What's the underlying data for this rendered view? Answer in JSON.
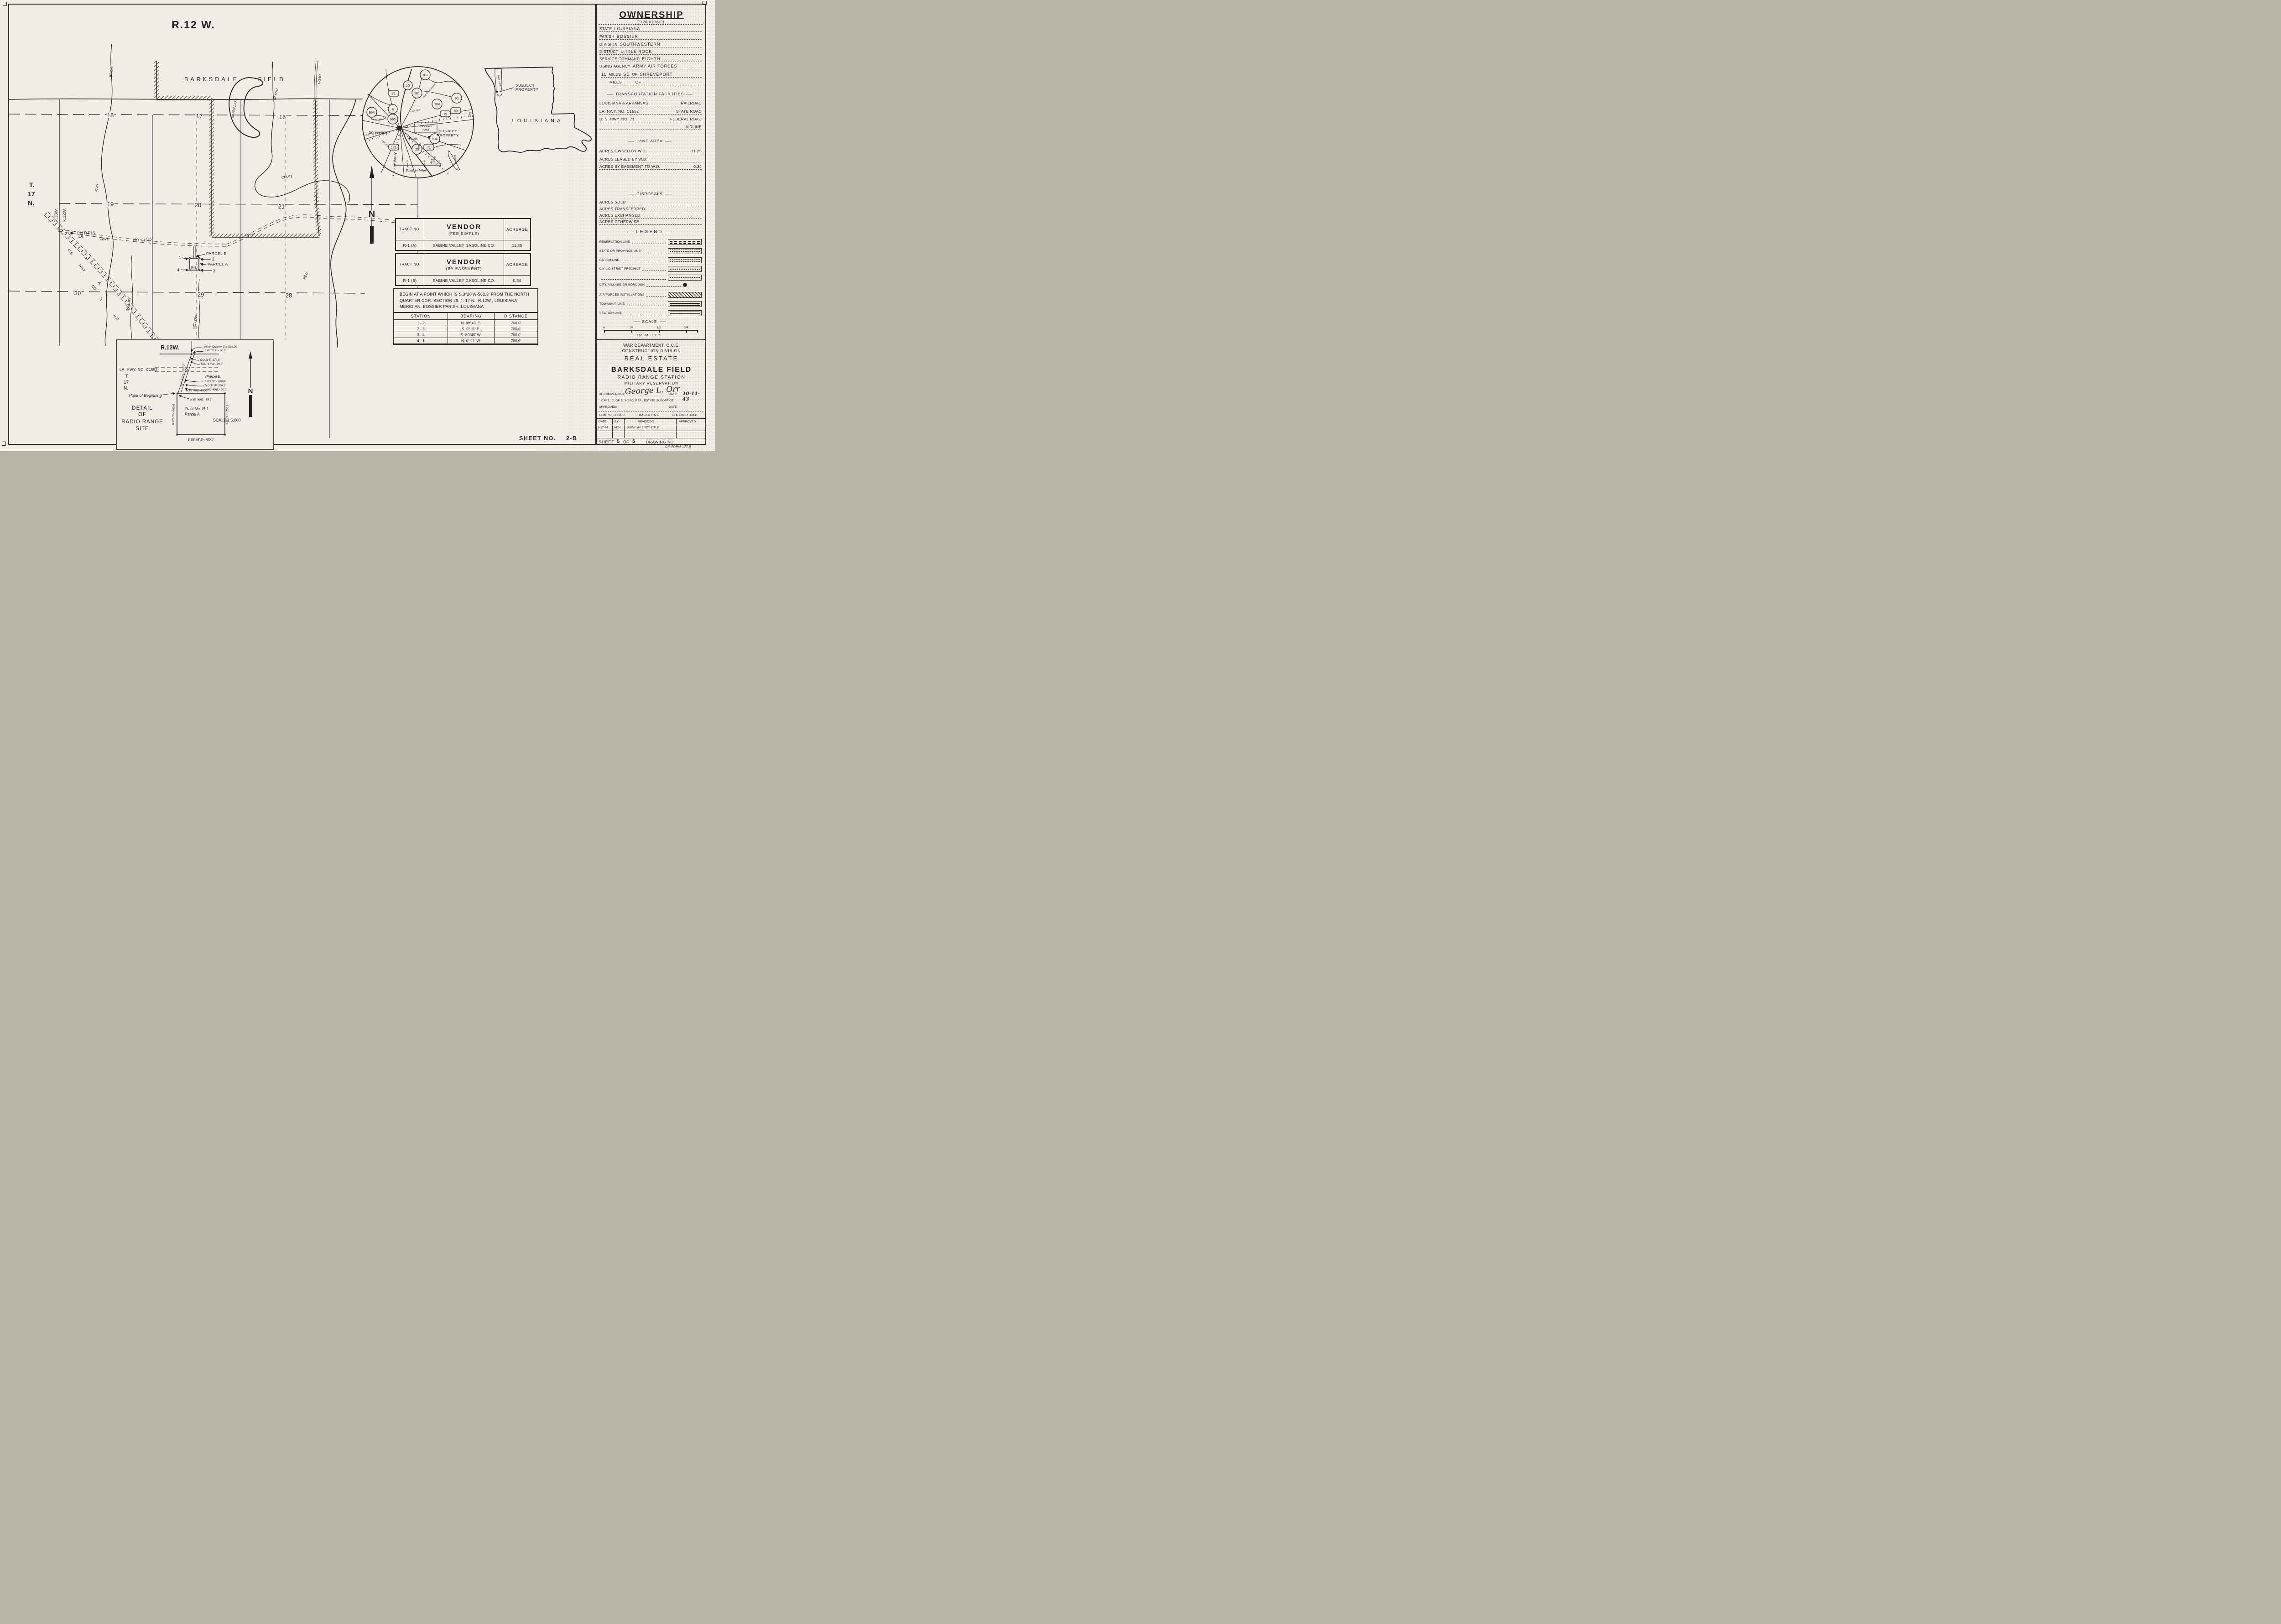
{
  "sheet": {
    "sheet_no_label": "SHEET NO.",
    "sheet_no_value": "2-B",
    "form_no": "CR-FORM-177.B"
  },
  "ownership": {
    "title": "OWNERSHIP",
    "subtitle": "(TYPE OF MAP)",
    "rows": [
      {
        "label": "STATE",
        "value": "LOUISIANA"
      },
      {
        "label": "PARISH",
        "value": "BOSSIER"
      },
      {
        "label": "DIVISION",
        "value": "SOUTHWESTERN"
      },
      {
        "label": "DISTRICT",
        "value": "LITTLE ROCK"
      },
      {
        "label": "SERVICE COMMAND",
        "value": "EIGHTH"
      },
      {
        "label": "USING AGENCY",
        "value": "ARMY AIR FORCES"
      }
    ],
    "distance1": {
      "n": "11",
      "miles": "MILES",
      "dir": "SE",
      "of": "OF",
      "place": "SHREVEPORT"
    },
    "distance2": {
      "miles": "MILES",
      "of": "OF"
    }
  },
  "transportation": {
    "header": "TRANSPORTATION FACILITIES",
    "r1": {
      "name": "LOUISIANA & ARKANSAS",
      "type": "RAILROAD"
    },
    "r2": {
      "name": "LA. HWY. NO. C1552",
      "type": "STATE ROAD"
    },
    "r3": {
      "name": "U. S. HWY. NO. 71",
      "type": "FEDERAL ROAD"
    },
    "r4": {
      "name": "",
      "type": "AIRLINE"
    }
  },
  "land_area": {
    "header": "LAND AREA",
    "rows": [
      {
        "label": "ACRES OWNED BY W.D.",
        "value": "11.25"
      },
      {
        "label": "ACRES LEASED BY W.D.",
        "value": ""
      },
      {
        "label": "ACRES BY EASEMENT TO W.D.",
        "value": "0.34"
      }
    ]
  },
  "disposals": {
    "header": "DISPOSALS",
    "rows": [
      {
        "label": "ACRES SOLD",
        "value": ""
      },
      {
        "label": "ACRES TRANSFERRED",
        "value": ""
      },
      {
        "label": "ACRES EXCHANGED",
        "value": ""
      },
      {
        "label": "ACRES OTHERWISE",
        "value": ""
      }
    ]
  },
  "legend": {
    "header": "LEGEND",
    "items": [
      {
        "label": "RESERVATION LINE"
      },
      {
        "label": "STATE OR PROVINCE LINE"
      },
      {
        "label": "PARISH LINE"
      },
      {
        "label": "CIVIL DISTRICT PRECINCT"
      },
      {
        "label": ""
      },
      {
        "label": "CITY, VILLAGE OR BOROUGH"
      },
      {
        "label": "AIR FORCES INSTALLATIONS"
      },
      {
        "label": "TOWNSHIP LINE"
      },
      {
        "label": "SECTION LINE"
      }
    ],
    "scale_header": "SCALE",
    "scale_ticks": [
      "0",
      "1/4",
      "1/2",
      "3/4"
    ],
    "scale_units": "IN MILES"
  },
  "title_block": {
    "dept": "WAR DEPARTMENT, O.C.E.",
    "division": "CONSTRUCTION DIVISION",
    "category": "REAL ESTATE",
    "installation": "BARKSDALE FIELD",
    "station": "RADIO RANGE STATION",
    "reservation": "MILITARY RESERVATION",
    "recommended_label": "RECOMMENDED:",
    "signature": "George L. Orr",
    "date_label": "DATE:",
    "date_value": "10-11-43",
    "signer_title": "CAPT., C. OF E., HEAD, REAL ESTATE SUBOFFICE",
    "approved_label": "APPROVED:",
    "approved_date_label": "DATE:",
    "compiled": "COMPILED F.A.C.",
    "traced": "TRACED F.A.C.",
    "checked": "CHECKED B.R.P."
  },
  "revisions": {
    "date_header": "DATE",
    "by_header": "BY",
    "revisions_header": "REVISIONS",
    "approved_header": "APPROVED",
    "row_date": "3-17-44",
    "row_by": "HEN",
    "row_text": "USING AGENCY TITLE",
    "row_approved": ""
  },
  "sheet_line": {
    "label": "SHEET",
    "number": "5",
    "of": "OF",
    "total": "5",
    "drawing_label": "DRAWING NO."
  },
  "vendor_fee": {
    "tract_header": "TRACT NO.",
    "vendor_header": "VENDOR",
    "vendor_sub": "(FEE SIMPLE)",
    "acreage_header": "ACREAGE",
    "tract": "R-1 (A)",
    "vendor": "SABINE VALLEY GASOLINE CO.",
    "acreage": "11.25"
  },
  "vendor_easement": {
    "tract_header": "TRACT NO.",
    "vendor_header": "VENDOR",
    "vendor_sub": "(BY EASEMENT)",
    "acreage_header": "ACREAGE",
    "tract": "R-1 (B)",
    "vendor": "SABINE VALLEY GASOLINE CO.",
    "acreage": "0.34"
  },
  "metes_bounds": {
    "description": "BEGIN AT A POINT WHICH IS S.3°20'W-563.3' FROM THE NORTH QUARTER COR. SECTION 29, T. 17 N., R.12W., LOUISIANA MERIDIAN, BOSSIER PARISH, LOUISIANA",
    "station_header": "STATION",
    "bearing_header": "BEARING",
    "distance_header": "DISTANCE",
    "rows": [
      {
        "station": "1 - 2",
        "bearing": "N. 89°49' E.",
        "distance": "700.0'"
      },
      {
        "station": "2 - 3",
        "bearing": "S. 0° 11' E.",
        "distance": "700.0'"
      },
      {
        "station": "3 - 4",
        "bearing": "S. 89°49' W.",
        "distance": "700.0'"
      },
      {
        "station": "4 - 1",
        "bearing": "N. 0° 11' W.",
        "distance": "700.0'"
      }
    ]
  },
  "main_map": {
    "range_label": "R.12 W.",
    "field_1": "BARKSDALE",
    "field_2": "FIELD",
    "t": "T.",
    "t17": "17",
    "tn": "N.",
    "range_left": "R.13W.",
    "range_right": "R.12W.",
    "s18": "18",
    "s17": "17",
    "s16": "16",
    "s19": "19",
    "s20": "20",
    "s21": "21",
    "s30": "30",
    "s29": "29",
    "s28": "28",
    "curtis": "CURTIS",
    "la": "LA.",
    "hwy": "HWY.",
    "no_c1552": "NO. C1552",
    "us": "U.S.",
    "us_hwy": "HWY.",
    "us_no": "NO.",
    "us_71": "71",
    "rr_l": "L.",
    "rr_a": "A.",
    "rr_rr": "R.R.",
    "river": "RIVER",
    "flat": "FLAT",
    "chute": "CHUTE",
    "bayou": "BAYOU",
    "red": "RED",
    "road": "ROAD",
    "moon_lake": "MOON LAKE",
    "willow": "WILLOW",
    "parcel_a": "PARCEL A",
    "parcel_b": "PARCEL B",
    "tract": "R-1",
    "c1": "1",
    "c2": "2",
    "c3": "3",
    "c4": "4",
    "north": "N"
  },
  "vicinity": {
    "shield_182": "182",
    "shield_10": "10",
    "shield_181": "181",
    "shield_71": "71",
    "shield_90": "90",
    "shield_184": "184",
    "shield_80": "80",
    "shield_79": "79",
    "shield_8": "8",
    "shield_994": "994",
    "shield_995": "995",
    "shield_934": "934",
    "shield_20": "20",
    "shield_171": "171",
    "shield_71b": "71",
    "shreveport": "Shreveport",
    "cross_lake": "Cross Lake",
    "field_1": "Barksdale",
    "field_2": "Field",
    "subject_1": "SUBJECT",
    "subject_2": "PROPERTY",
    "curtis": "Curtis",
    "red": "RED",
    "river": "RIVER",
    "rr_la": "L.&A. R.R.",
    "rr_ic": "I.C. R.R.",
    "rr_kcs": "K.C.S.R.R.",
    "rr_tp": "T.&P. R.R.",
    "rr_lat": "L.A.&T. R.R.",
    "bayou": "Red Chute Bayou",
    "bayou2": "Bayou",
    "bistineau": "Bistineau",
    "scale_5a": "5",
    "scale_0": "0",
    "scale_5b": "5",
    "scale_10": "10",
    "scale_label": "Scale in Miles"
  },
  "state_map": {
    "name": "LOUISIANA",
    "parish": "BOSSIER",
    "subject_1": "SUBJECT",
    "subject_2": "PROPERTY"
  },
  "detail": {
    "range": "R.12W.",
    "qc_1": "North Quarter Cor.Sec.29",
    "qc_2": "S.88°21'E.- 30.5'",
    "a_1": "S.0°11'E.-274.5'",
    "a_2": "S.81°17'W.- 30.5'",
    "hwy": "LA. HWY. NO. C1552",
    "t": "T.",
    "t17": "17",
    "tn": "N.",
    "pb": "(Parcel B)",
    "pb_1": "S.0°11'E.- 286.8'",
    "pb_2": "N.0°11'W.-294.2'",
    "pb_3": "N.89°49'E.- 30.0'",
    "top_bearing": "N.89°49'E.-700.0'",
    "pob_offset": "N.89°49'E.- 65.0'",
    "tie": "S.3°20'W.- 563.3'",
    "pob": "Point of Beginning",
    "d1": "DETAIL",
    "d2": "OF",
    "d3": "RADIO RANGE",
    "d4": "SITE",
    "tract_1": "Tract No. R-1",
    "tract_2": "Parcel A",
    "left": "N.0°11'W.-700.0'",
    "right": "S.0°11'E.-700.0'",
    "bottom": "S.89°49'W.- 700.0'",
    "scale": "SCALE 1:5,000",
    "north": "N"
  }
}
